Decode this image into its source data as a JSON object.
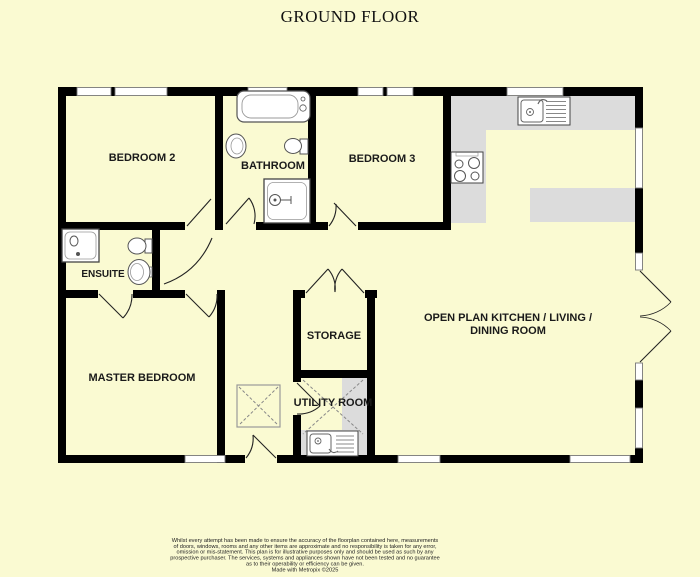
{
  "title": "GROUND FLOOR",
  "rooms": {
    "bedroom2": {
      "label": "BEDROOM 2"
    },
    "bathroom": {
      "label": "BATHROOM"
    },
    "bedroom3": {
      "label": "BEDROOM 3"
    },
    "ensuite": {
      "label": "ENSUITE"
    },
    "master": {
      "label": "MASTER BEDROOM"
    },
    "storage": {
      "label": "STORAGE"
    },
    "utility": {
      "label": "UTILITY ROOM"
    },
    "openplan": {
      "label": "OPEN PLAN KITCHEN / LIVING / DINING ROOM",
      "line1": "OPEN PLAN KITCHEN / LIVING /",
      "line2": "DINING ROOM"
    }
  },
  "fixtures": [
    "bathtub",
    "bath-basin",
    "bath-toilet",
    "bath-shower",
    "ensuite-shower",
    "ensuite-toilet",
    "ensuite-basin",
    "kitchen-sink",
    "hob",
    "utility-sink",
    "rooflight"
  ],
  "colors": {
    "background": "#FAFAD2",
    "wall": "#000000",
    "counter": "#DCDCDC",
    "window_fill": "#FFFFFF",
    "fixture_outline": "#555555",
    "label_text": "#1a1a1a"
  },
  "disclaimer": {
    "lines": [
      "Whilst every attempt has been made to ensure the accuracy of the floorplan contained here, measurements",
      "of doors, windows, rooms and any other items are approximate and no responsibility is taken for any error,",
      "omission or mis-statement. This plan is for illustrative purposes only and should be used as such by any",
      "prospective purchaser. The services, systems and appliances shown have not been tested and no guarantee",
      "as to their operability or efficiency can be given."
    ],
    "credit": "Made with Metropix ©2025"
  }
}
